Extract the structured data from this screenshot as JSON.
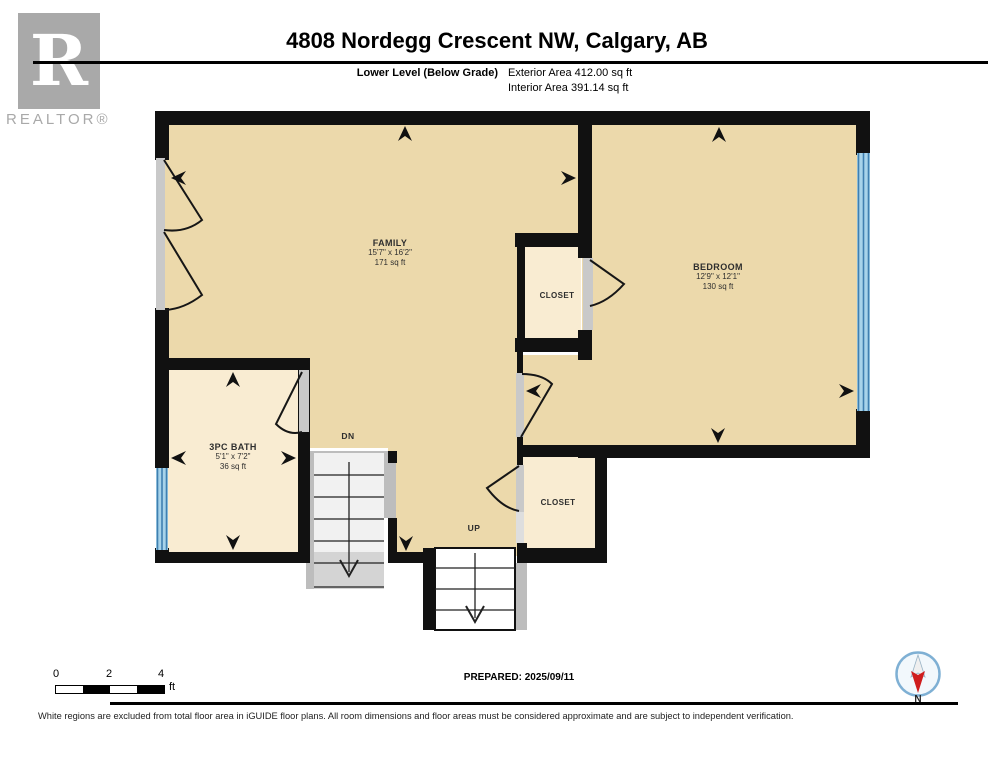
{
  "header": {
    "title": "4808 Nordegg Crescent NW, Calgary, AB",
    "level_label": "Lower Level (Below Grade)",
    "exterior_area": "Exterior Area 412.00 sq ft",
    "interior_area": "Interior Area 391.14 sq ft"
  },
  "logo": {
    "letter": "R",
    "wordmark": "REALTOR®"
  },
  "rooms": {
    "family": {
      "name": "FAMILY",
      "dims": "15'7\" x 16'2\"",
      "area": "171 sq ft"
    },
    "bedroom": {
      "name": "BEDROOM",
      "dims": "12'9\" x 12'1\"",
      "area": "130 sq ft"
    },
    "bath": {
      "name": "3PC BATH",
      "dims": "5'1\" x 7'2\"",
      "area": "36 sq ft"
    },
    "closet_upper": {
      "name": "CLOSET"
    },
    "closet_lower": {
      "name": "CLOSET"
    }
  },
  "stairs": {
    "down_label": "DN",
    "up_label": "UP"
  },
  "scale_bar": {
    "tick_0": "0",
    "tick_2": "2",
    "tick_4": "4",
    "unit": "ft"
  },
  "footer": {
    "prepared": "PREPARED: 2025/09/11",
    "disclaimer": "White regions are excluded from total floor area in iGUIDE floor plans. All room dimensions and floor areas must be considered approximate and are subject to independent verification."
  },
  "compass": {
    "label": "N"
  },
  "colors": {
    "wall": "#111111",
    "floor_main": "#ecd9ab",
    "floor_small": "#f9ecd2",
    "window": "#a7d3ea",
    "opening": "#c9c9c9",
    "stair_gray": "#bdbdbd",
    "logo_gray": "#a9a9a9",
    "compass_ring": "#7fb0d4",
    "compass_red": "#cf1d1d",
    "text": "#222222"
  }
}
